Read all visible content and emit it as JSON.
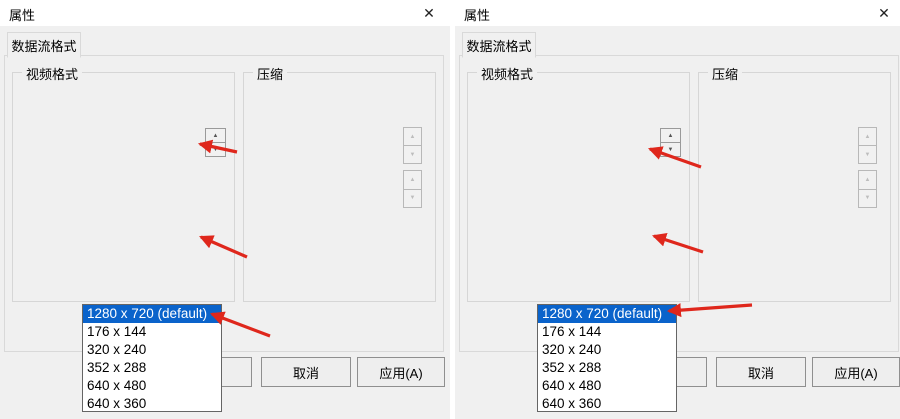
{
  "colors": {
    "selection_highlight": "#0a63cb",
    "annotation_arrow_red": "#df271c",
    "dialog_bg": "#f0f0f0",
    "titlebar_bg": "#ffffff"
  },
  "glyphs": {
    "close": "✕",
    "spin_up": "▲",
    "spin_down": "▼",
    "combo_arrow": "▼"
  },
  "dialogs": [
    {
      "title": "属性",
      "tab": "数据流格式",
      "video": {
        "group": "视频格式",
        "standard_label": "视频标准:",
        "standard_value": "None",
        "rate_label": "帧率(R):",
        "rate_value": "120.000",
        "flip_label": "横向翻转(F):",
        "snapshot": "快照",
        "colorspace_label": "颜色空间/压缩(C):",
        "colorspace_value": "MJPG",
        "outsize_label": "输出大小(S):",
        "outsize_value": "1280 x 720  (default)",
        "list": [
          "1280 x 720  (default)",
          "176 x 144",
          "320 x 240",
          "352 x 288",
          "640 x 480",
          "640 x 360"
        ]
      },
      "comp": {
        "group": "压缩",
        "i_label": "I 帧间隔(I):",
        "p_label": "P 帧间隔(P):",
        "q_label": "质量(Q):"
      },
      "buttons": {
        "cancel": "取消",
        "apply": "应用(A)"
      }
    },
    {
      "title": "属性",
      "tab": "数据流格式",
      "video": {
        "group": "视频格式",
        "standard_label": "视频标准:",
        "standard_value": "None",
        "rate_label": "帧率(R):",
        "rate_value": "10.000",
        "flip_label": "横向翻转(F):",
        "snapshot": "快照",
        "colorspace_label": "颜色空间/压缩(C):",
        "colorspace_value": "YUY2",
        "outsize_label": "输出大小(S):",
        "outsize_value": "1280 x 720  (default)",
        "list": [
          "1280 x 720  (default)",
          "176 x 144",
          "320 x 240",
          "352 x 288",
          "640 x 480",
          "640 x 360"
        ]
      },
      "comp": {
        "group": "压缩",
        "i_label": "I 帧间隔(I):",
        "p_label": "P 帧间隔(P):",
        "q_label": "质量(Q):"
      },
      "buttons": {
        "cancel": "取消",
        "apply": "应用(A)"
      }
    }
  ]
}
